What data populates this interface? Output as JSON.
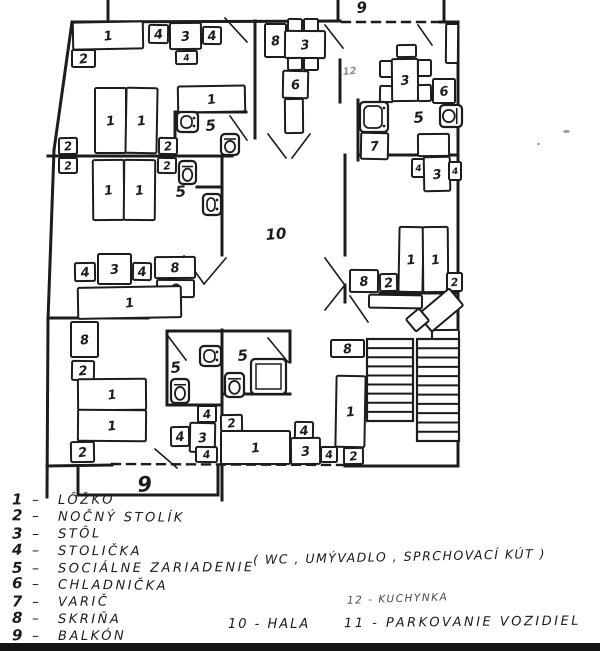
{
  "meta": {
    "ink": "#1c1c1c",
    "paper": "#ffffff",
    "scan_bar_color": "#141414"
  },
  "legend": {
    "items": [
      {
        "num": "1",
        "label": "LÔŽKO"
      },
      {
        "num": "2",
        "label": "NOČNÝ STOLÍK"
      },
      {
        "num": "3",
        "label": "STÔL"
      },
      {
        "num": "4",
        "label": "STOLIČKA"
      },
      {
        "num": "5",
        "label": "SOCIÁLNE ZARIADENIE"
      },
      {
        "num": "6",
        "label": "CHLADNIČKA"
      },
      {
        "num": "7",
        "label": "VARIČ"
      },
      {
        "num": "8",
        "label": "SKRIŇA"
      },
      {
        "num": "9",
        "label": "BALKÓN"
      }
    ],
    "note": "( WC , UMÝVADLO , SPRCHOVACÍ  KÚT )",
    "extras": [
      {
        "text": "12 - KUCHYNKA"
      },
      {
        "text": "10 -  HALA"
      },
      {
        "text": "11 -  PARKOVANIE  VOZIDIEL"
      }
    ]
  },
  "plan": {
    "walls": [
      [
        73,
        22,
        340,
        21
      ],
      [
        440,
        22,
        458,
        22
      ],
      [
        72,
        22,
        54,
        150
      ],
      [
        54,
        150,
        48,
        320
      ],
      [
        48,
        320,
        47,
        497
      ],
      [
        458,
        22,
        458,
        466
      ],
      [
        47,
        466,
        112,
        465
      ],
      [
        345,
        466,
        458,
        466
      ],
      [
        108,
        0,
        108,
        22
      ],
      [
        338,
        0,
        338,
        21
      ],
      [
        444,
        0,
        444,
        22
      ],
      [
        222,
        330,
        222,
        500
      ],
      [
        48,
        156,
        232,
        156
      ],
      [
        175,
        112,
        246,
        112
      ],
      [
        175,
        112,
        175,
        156
      ],
      [
        222,
        156,
        222,
        255
      ],
      [
        197,
        187,
        222,
        187
      ],
      [
        48,
        318,
        148,
        318
      ],
      [
        167,
        331,
        167,
        405
      ],
      [
        167,
        331,
        290,
        331
      ],
      [
        167,
        405,
        222,
        405
      ],
      [
        222,
        394,
        290,
        394
      ],
      [
        290,
        331,
        290,
        362
      ],
      [
        255,
        21,
        255,
        138
      ],
      [
        340,
        60,
        340,
        102
      ],
      [
        358,
        100,
        358,
        160
      ],
      [
        358,
        155,
        458,
        155
      ],
      [
        345,
        155,
        345,
        255
      ],
      [
        345,
        285,
        345,
        302
      ],
      [
        380,
        293,
        458,
        293
      ],
      [
        78,
        466,
        78,
        495
      ],
      [
        218,
        466,
        218,
        495
      ],
      [
        78,
        495,
        218,
        495
      ]
    ],
    "dashed_walls": [
      [
        342,
        22,
        440,
        22
      ],
      [
        112,
        464,
        343,
        465
      ]
    ],
    "door_swings": [
      [
        225,
        18,
        247,
        42
      ],
      [
        325,
        25,
        343,
        48
      ],
      [
        418,
        25,
        432,
        45
      ],
      [
        230,
        116,
        247,
        140
      ],
      [
        184,
        256,
        204,
        284
      ],
      [
        204,
        284,
        226,
        258
      ],
      [
        268,
        134,
        286,
        158
      ],
      [
        310,
        134,
        292,
        158
      ],
      [
        168,
        336,
        186,
        360
      ],
      [
        268,
        338,
        288,
        362
      ],
      [
        350,
        296,
        368,
        322
      ],
      [
        155,
        449,
        177,
        468
      ],
      [
        325,
        258,
        344,
        284
      ],
      [
        325,
        310,
        344,
        286
      ]
    ],
    "furniture_columns": [
      "x",
      "y",
      "w",
      "h",
      "label",
      "rotation"
    ],
    "furniture": [
      [
        73,
        22,
        70,
        27,
        "1"
      ],
      [
        72,
        50,
        23,
        17,
        "2"
      ],
      [
        149,
        25,
        19,
        18,
        "4"
      ],
      [
        170,
        23,
        31,
        26,
        "3"
      ],
      [
        203,
        27,
        18,
        17,
        "4"
      ],
      [
        176,
        51,
        21,
        13,
        "4"
      ],
      [
        95,
        88,
        31,
        65,
        "1"
      ],
      [
        126,
        88,
        31,
        65,
        "1"
      ],
      [
        59,
        138,
        18,
        16,
        "2"
      ],
      [
        159,
        138,
        18,
        16,
        "2"
      ],
      [
        178,
        86,
        67,
        26,
        "1"
      ],
      [
        59,
        158,
        18,
        15,
        "2"
      ],
      [
        158,
        158,
        18,
        15,
        "2"
      ],
      [
        93,
        160,
        31,
        60,
        "1"
      ],
      [
        124,
        160,
        31,
        60,
        "1"
      ],
      [
        75,
        263,
        20,
        18,
        "4"
      ],
      [
        98,
        254,
        33,
        30,
        "3"
      ],
      [
        133,
        263,
        18,
        17,
        "4"
      ],
      [
        155,
        257,
        40,
        21,
        "8"
      ],
      [
        157,
        280,
        37,
        17,
        "8"
      ],
      [
        78,
        287,
        103,
        31,
        "1"
      ],
      [
        71,
        322,
        27,
        35,
        "8"
      ],
      [
        72,
        361,
        22,
        19,
        "2"
      ],
      [
        78,
        379,
        68,
        31,
        "1"
      ],
      [
        78,
        410,
        68,
        31,
        "1"
      ],
      [
        71,
        442,
        23,
        20,
        "2"
      ],
      [
        198,
        406,
        18,
        16,
        "4"
      ],
      [
        190,
        423,
        25,
        29,
        "3"
      ],
      [
        171,
        427,
        18,
        19,
        "4"
      ],
      [
        196,
        447,
        21,
        15,
        "4"
      ],
      [
        221,
        415,
        21,
        16,
        "2"
      ],
      [
        221,
        431,
        69,
        33,
        "1"
      ],
      [
        295,
        422,
        18,
        17,
        "4"
      ],
      [
        291,
        438,
        29,
        26,
        "3"
      ],
      [
        321,
        447,
        16,
        15,
        "4"
      ],
      [
        346,
        447,
        15,
        15,
        "2"
      ],
      [
        265,
        24,
        21,
        33,
        "8"
      ],
      [
        288,
        19,
        14,
        12,
        ""
      ],
      [
        304,
        19,
        14,
        12,
        ""
      ],
      [
        285,
        31,
        40,
        27,
        "3"
      ],
      [
        288,
        58,
        14,
        12,
        ""
      ],
      [
        304,
        58,
        14,
        12,
        ""
      ],
      [
        283,
        71,
        25,
        27,
        "6"
      ],
      [
        285,
        99,
        18,
        34,
        ""
      ],
      [
        446,
        24,
        12,
        39,
        ""
      ],
      [
        397,
        45,
        19,
        12,
        ""
      ],
      [
        380,
        61,
        13,
        16,
        ""
      ],
      [
        380,
        86,
        13,
        16,
        ""
      ],
      [
        392,
        59,
        26,
        42,
        "3"
      ],
      [
        418,
        60,
        13,
        16,
        ""
      ],
      [
        418,
        85,
        13,
        16,
        ""
      ],
      [
        433,
        79,
        22,
        24,
        "6"
      ],
      [
        361,
        133,
        27,
        26,
        "7"
      ],
      [
        418,
        134,
        31,
        22,
        ""
      ],
      [
        412,
        159,
        13,
        18,
        "4"
      ],
      [
        424,
        157,
        26,
        34,
        "3"
      ],
      [
        449,
        162,
        12,
        18,
        "4"
      ],
      [
        399,
        227,
        24,
        65,
        "1"
      ],
      [
        423,
        227,
        25,
        65,
        "1"
      ],
      [
        350,
        270,
        28,
        22,
        "8"
      ],
      [
        380,
        274,
        17,
        17,
        "2"
      ],
      [
        447,
        273,
        15,
        18,
        "2"
      ],
      [
        369,
        295,
        53,
        13,
        ""
      ],
      [
        432,
        330,
        27,
        16,
        ""
      ],
      [
        420,
        299,
        41,
        22,
        "",
        -40
      ],
      [
        409,
        312,
        17,
        16,
        "",
        -40
      ],
      [
        331,
        340,
        33,
        17,
        "8"
      ],
      [
        336,
        376,
        29,
        71,
        "1"
      ],
      [
        344,
        448,
        19,
        16,
        "2"
      ]
    ],
    "fixtures": [
      {
        "type": "sink",
        "x": 177,
        "y": 112,
        "w": 21,
        "h": 20
      },
      {
        "type": "toilet",
        "x": 221,
        "y": 134,
        "w": 18,
        "h": 21
      },
      {
        "type": "toilet",
        "x": 179,
        "y": 161,
        "w": 17,
        "h": 23
      },
      {
        "type": "sink",
        "x": 203,
        "y": 194,
        "w": 18,
        "h": 21
      },
      {
        "type": "toilet",
        "x": 171,
        "y": 379,
        "w": 18,
        "h": 24
      },
      {
        "type": "sink",
        "x": 200,
        "y": 346,
        "w": 21,
        "h": 20
      },
      {
        "type": "toilet",
        "x": 225,
        "y": 373,
        "w": 19,
        "h": 24
      },
      {
        "type": "shower",
        "x": 251,
        "y": 359,
        "w": 35,
        "h": 35
      },
      {
        "type": "sink",
        "x": 360,
        "y": 102,
        "w": 28,
        "h": 30
      },
      {
        "type": "toilet",
        "x": 440,
        "y": 105,
        "w": 22,
        "h": 22,
        "rot": 90
      }
    ],
    "stairs": [
      {
        "x": 367,
        "y": 339,
        "w": 46,
        "h": 82,
        "steps": 8
      },
      {
        "x": 417,
        "y": 339,
        "w": 42,
        "h": 102,
        "steps": 10
      }
    ],
    "room_labels": [
      {
        "text": "10",
        "x": 266,
        "y": 240,
        "size": 15
      },
      {
        "text": "9",
        "x": 357,
        "y": 13,
        "size": 15
      },
      {
        "text": "9",
        "x": 138,
        "y": 492,
        "size": 21
      },
      {
        "text": "5",
        "x": 206,
        "y": 131,
        "size": 15
      },
      {
        "text": "5",
        "x": 176,
        "y": 197,
        "size": 15
      },
      {
        "text": "5",
        "x": 171,
        "y": 373,
        "size": 15
      },
      {
        "text": "5",
        "x": 238,
        "y": 361,
        "size": 15
      },
      {
        "text": "5",
        "x": 414,
        "y": 123,
        "size": 15
      },
      {
        "text": "12",
        "x": 343,
        "y": 75,
        "size": 10,
        "faint": true
      }
    ]
  }
}
